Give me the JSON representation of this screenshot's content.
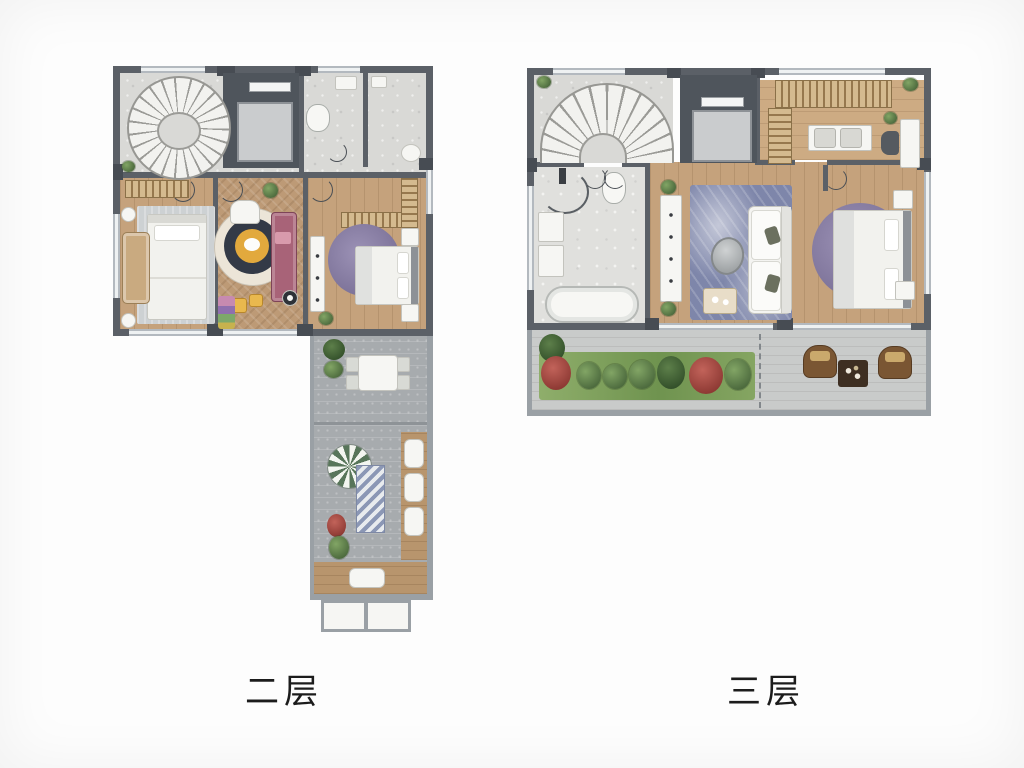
{
  "figure": {
    "type": "architectural-floor-plans",
    "plans": [
      {
        "id": "second-floor",
        "caption": "二层"
      },
      {
        "id": "third-floor",
        "caption": "三层"
      }
    ]
  },
  "palette": {
    "wall": "#5b6067",
    "pier": "#474c53",
    "stone": "#d9d9d6",
    "marble": "#e0e0dd",
    "wood": "#c5a27c",
    "woodLight": "#cdab83",
    "terrace": "#a7abae",
    "terraceLight": "#c9cbca",
    "rugGray": "#cdd1d3",
    "rugPurple": "#7d7399",
    "rugBlue": "#7e86aa",
    "sofaMauve": "#a86378",
    "accentYellow": "#e9b84e",
    "plantGreen": "#4d6b3e",
    "plantRed": "#8e3a34",
    "deckWood": "#b8956d",
    "elevatorShaft": "#4f555c",
    "elevatorCar": "#caccce",
    "furnitureWhite": "#f6f6f3",
    "captionColor": "#1c1c1c"
  }
}
